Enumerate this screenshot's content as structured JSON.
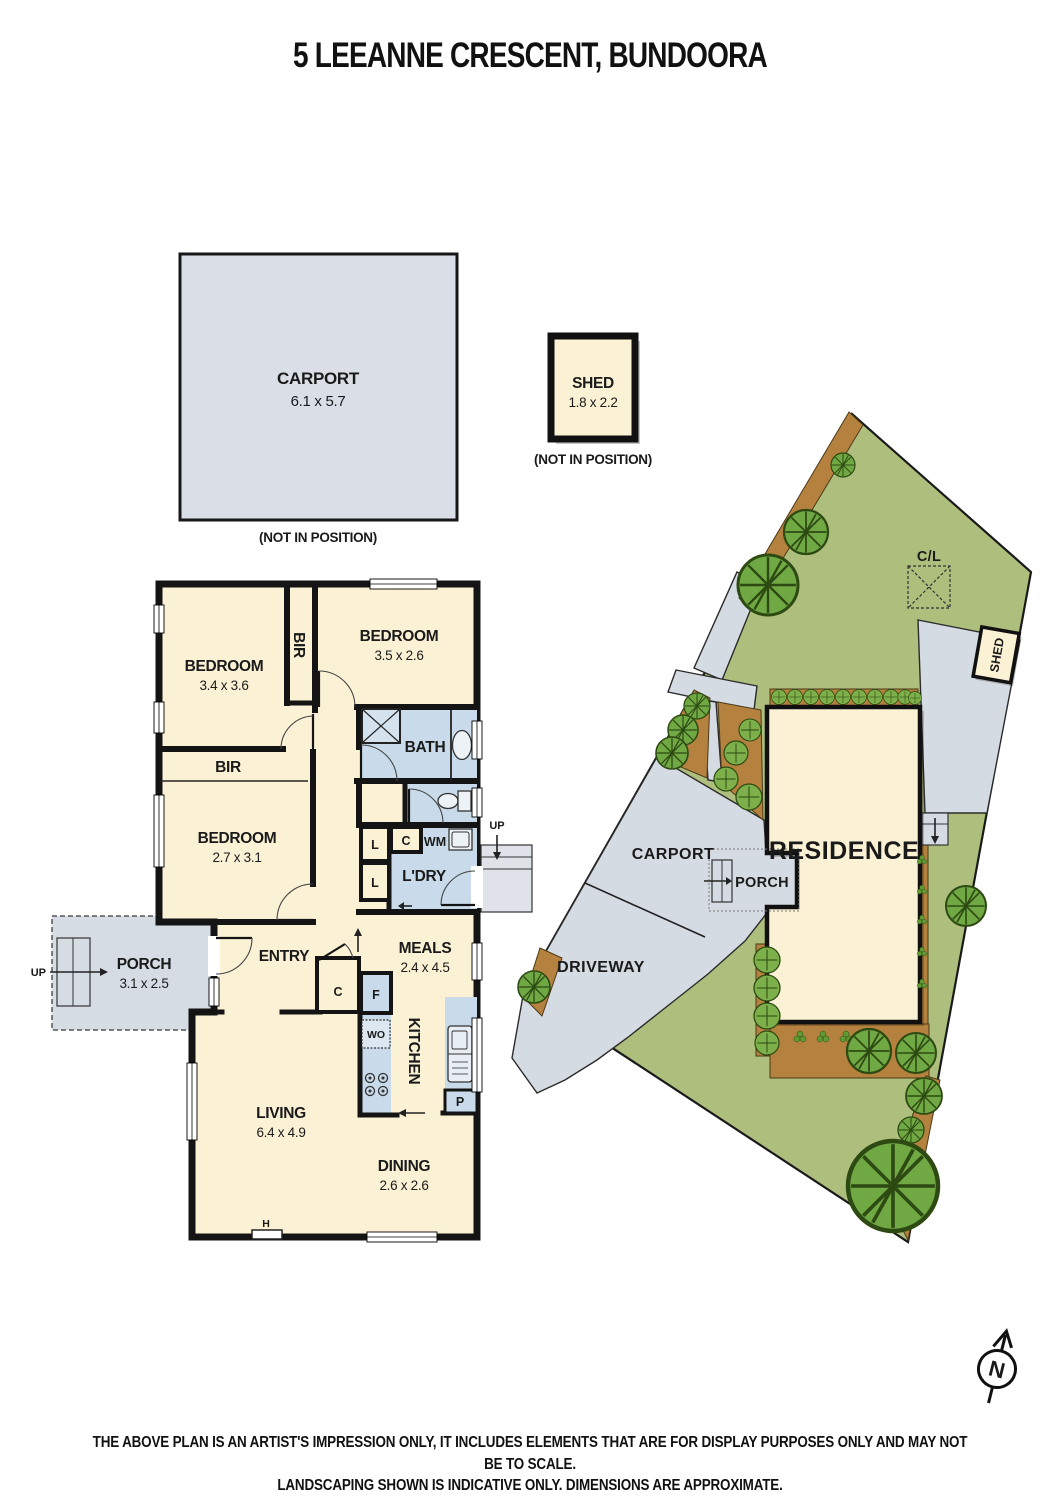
{
  "title": "5 LEEANNE CRESCENT, BUNDOORA",
  "palette": {
    "wall": "#141414",
    "room_cream": "#FBF2D5",
    "wet_blue": "#C9DBEA",
    "porch_gray": "#D6DCE3",
    "carport_gray": "#DADFE7",
    "lawn_green": "#AEBF7D",
    "paving_gray": "#D5DBE2",
    "garden_brown": "#B5813F",
    "tree_green": "#70A844",
    "tree_outline": "#2D4A12",
    "text_dark": "#1A1A1A"
  },
  "detached_carport": {
    "label": "CARPORT",
    "dims": "6.1 x 5.7",
    "note": "(NOT IN POSITION)"
  },
  "detached_shed": {
    "label": "SHED",
    "dims": "1.8 x 2.2",
    "note": "(NOT IN POSITION)"
  },
  "floorplan": {
    "bedroom1_label": "BEDROOM",
    "bedroom1_dims": "3.4 x 3.6",
    "bedroom2_label": "BEDROOM",
    "bedroom2_dims": "3.5 x 2.6",
    "bedroom3_label": "BEDROOM",
    "bedroom3_dims": "2.7 x 3.1",
    "bir_vertical": "BIR",
    "bir_horizontal": "BIR",
    "bath": "BATH",
    "laundry": "L'DRY",
    "linen_upper": "L",
    "linen_lower": "L",
    "hall_cupboard": "C",
    "washing_machine": "WM",
    "up_rear": "UP",
    "up_porch": "UP",
    "entry": "ENTRY",
    "entry_cupboard": "C",
    "meals_label": "MEALS",
    "meals_dims": "2.4 x 4.5",
    "fridge": "F",
    "kitchen": "KITCHEN",
    "wall_oven": "WO",
    "pantry": "P",
    "living_label": "LIVING",
    "living_dims": "6.4 x 4.9",
    "dining_label": "DINING",
    "dining_dims": "2.6 x 2.6",
    "heater": "H",
    "porch_label": "PORCH",
    "porch_dims": "3.1 x 2.5"
  },
  "siteplan": {
    "residence": "RESIDENCE",
    "carport": "CARPORT",
    "porch": "PORCH",
    "driveway": "DRIVEWAY",
    "shed": "SHED",
    "clothesline": "C/L"
  },
  "compass": {
    "north": "N"
  },
  "disclaimer_line1": "THE ABOVE PLAN IS AN ARTIST'S IMPRESSION ONLY, IT INCLUDES ELEMENTS THAT ARE FOR DISPLAY PURPOSES ONLY AND MAY NOT BE TO SCALE.",
  "disclaimer_line2": "LANDSCAPING SHOWN IS INDICATIVE ONLY. DIMENSIONS ARE APPROXIMATE."
}
